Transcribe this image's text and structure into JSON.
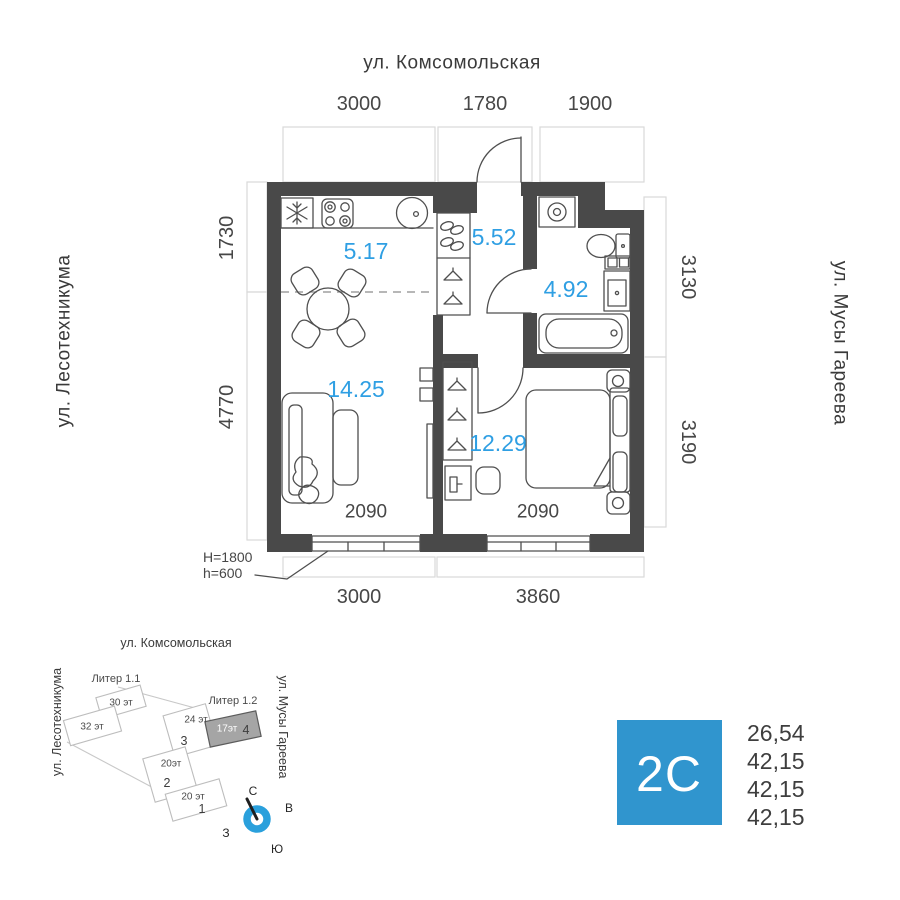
{
  "streets": {
    "top": "ул. Комсомольская",
    "left": "ул. Лесотехникума",
    "right": "ул. Мусы Гареева"
  },
  "dimensions": {
    "top": [
      "3000",
      "1780",
      "1900"
    ],
    "left": [
      "1730",
      "4770"
    ],
    "right": [
      "3130",
      "3190"
    ],
    "bottom": [
      "3000",
      "3860"
    ],
    "window_widths": [
      "2090",
      "2090"
    ],
    "window_heights": [
      "H=1800",
      "h=600"
    ]
  },
  "rooms": [
    {
      "id": "kitchen",
      "area": "5.17"
    },
    {
      "id": "hall",
      "area": "5.52"
    },
    {
      "id": "bathroom",
      "area": "4.92"
    },
    {
      "id": "living",
      "area": "14.25"
    },
    {
      "id": "bedroom",
      "area": "12.29"
    }
  ],
  "site_plan": {
    "street_top": "ул. Комсомольская",
    "street_left": "ул. Лесотехникума",
    "street_right": "ул. Мусы Гареева",
    "liter_labels": [
      "Литер 1.1",
      "Литер 1.2"
    ],
    "buildings": [
      {
        "floors": "30 эт",
        "number": ""
      },
      {
        "floors": "32 эт",
        "number": ""
      },
      {
        "floors": "24 эт",
        "number": "3"
      },
      {
        "floors": "20эт",
        "number": "2"
      },
      {
        "floors": "20 эт",
        "number": "1"
      },
      {
        "floors": "17эт",
        "number": "4",
        "highlighted": true
      }
    ],
    "compass": {
      "north": "С",
      "east": "В",
      "south": "Ю",
      "west": "З"
    }
  },
  "unit_card": {
    "type_label": "2C",
    "areas": [
      "26,54",
      "42,15",
      "42,15",
      "42,15"
    ]
  },
  "colors": {
    "wall": "#494949",
    "area_label": "#2f9fe3",
    "accent_blue": "#3095ce",
    "compass_blue": "#2aa0dc"
  }
}
